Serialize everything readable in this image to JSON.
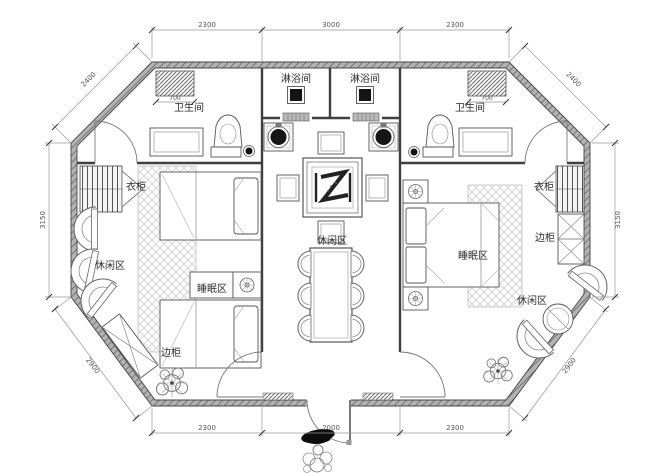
{
  "labels": {
    "shower_room_left": "淋浴间",
    "shower_room_right": "淋浴间",
    "bathroom_left": "卫生间",
    "bathroom_right": "卫生间",
    "wardrobe_left": "衣柜",
    "wardrobe_right": "衣柜",
    "sleeping_area_left": "睡眠区",
    "sleeping_area_right": "睡眠区",
    "leisure_area_left": "休闲区",
    "leisure_area_center": "休闲区",
    "leisure_area_right": "休闲区",
    "side_cabinet_left": "边柜",
    "side_cabinet_right": "边柜"
  },
  "dimensions": {
    "top_left": "2300",
    "top_center": "3000",
    "top_right": "2300",
    "bottom_left": "2300",
    "bottom_center": "2000",
    "bottom_right": "2300",
    "side_left": "3150",
    "side_right": "3150",
    "diagonal_top_left": "2400",
    "diagonal_top_right": "2400",
    "diagonal_bottom_left": "2900",
    "diagonal_bottom_right": "2900",
    "vanity_width_left": "700",
    "vanity_width_right": "700"
  },
  "colors": {
    "wall": "#b3b3b3",
    "line": "#3f3f3f",
    "dimension": "#555555",
    "label": "#2b2b2b",
    "background": "#ffffff"
  }
}
